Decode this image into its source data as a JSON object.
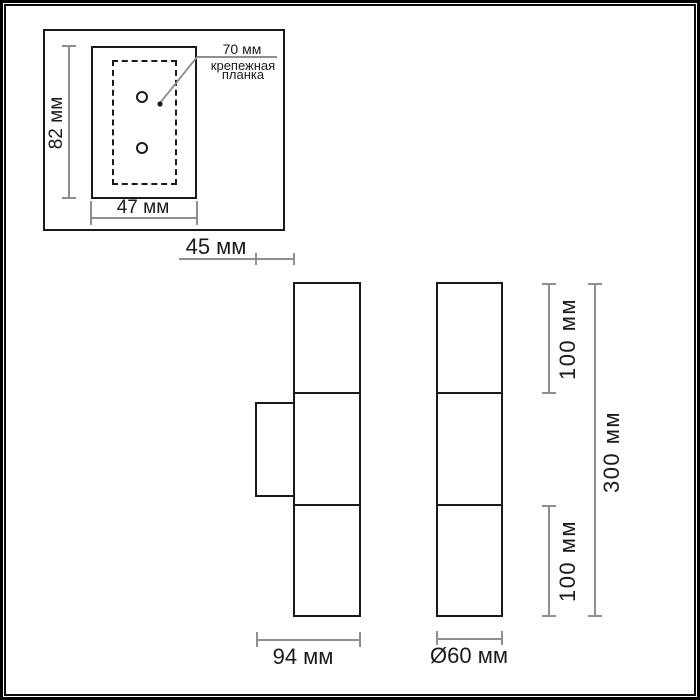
{
  "drawing": {
    "top_view": {
      "height": "82 мм",
      "width": "47 мм",
      "plate_width": "70 мм",
      "callout_line1": "крепежная",
      "callout_line2": "планка"
    },
    "front_view": {
      "bracket_depth": "45 мм",
      "total_depth": "94 мм"
    },
    "side_view": {
      "upper_section_height": "100 мм",
      "lower_section_height": "100 мм",
      "total_height": "300 мм",
      "diameter": "Ø60 мм"
    }
  },
  "colors": {
    "outline": "#1a1a1a",
    "dimension_line": "#8f8f8f",
    "background": "#ffffff"
  }
}
